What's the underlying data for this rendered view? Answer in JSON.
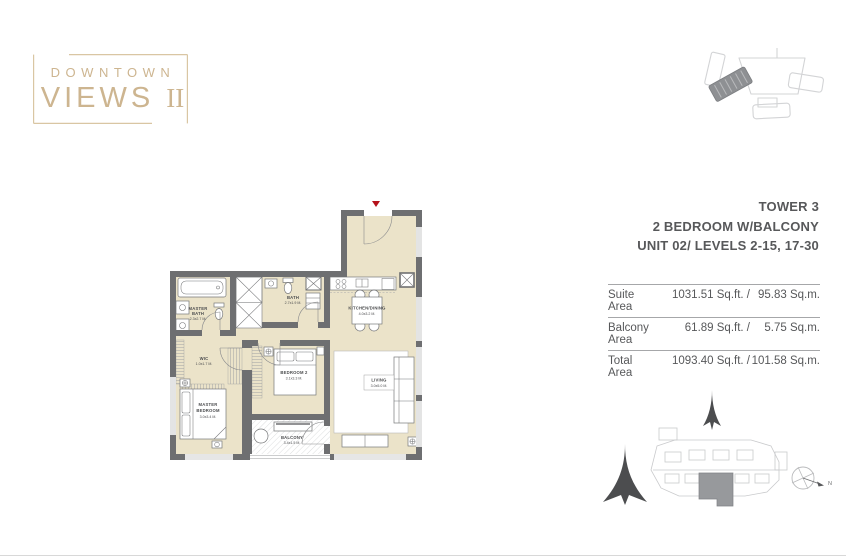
{
  "brand": {
    "line1": "DOWNTOWN",
    "line2": "VIEWS",
    "numeral": "II"
  },
  "unit_info": {
    "tower": "TOWER 3",
    "type": "2 BEDROOM W/BALCONY",
    "unit": "UNIT 02/ LEVELS 2-15, 17-30"
  },
  "area_table": {
    "rows": [
      {
        "label": "Suite Area",
        "sqft": "1031.51 Sq.ft. /",
        "sqm": "95.83 Sq.m."
      },
      {
        "label": "Balcony Area",
        "sqft": "61.89 Sq.ft. /",
        "sqm": "5.75 Sq.m."
      },
      {
        "label": "Total Area",
        "sqft": "1093.40 Sq.ft. /",
        "sqm": "101.58 Sq.m."
      }
    ]
  },
  "floor_plan": {
    "rooms": {
      "master_bath": {
        "line1": "MASTER",
        "line2": "BATH",
        "dims": "2.3x2.7 M."
      },
      "bath": {
        "name": "BATH",
        "dims": "2.7x1.9 M."
      },
      "wic": {
        "name": "WIC",
        "dims": "1.0x1.7 M."
      },
      "master_bedroom": {
        "line1": "MASTER",
        "line2": "BEDROOM",
        "dims": "3.0x3.4 M."
      },
      "bedroom2": {
        "name": "BEDROOM 2",
        "dims": "3.1x3.3 M."
      },
      "kitchen_dining": {
        "name": "KITCHEN/DINING",
        "dims": "4.0x3.2 M."
      },
      "living": {
        "name": "LIVING",
        "dims": "3.0x5.0 M."
      },
      "balcony": {
        "name": "BALCONY",
        "dims": "3.4x1.5 M."
      }
    }
  },
  "compass": {
    "label": "N"
  },
  "colors": {
    "accent_gold": "#cfb68f",
    "wall_gray": "#6e6f71",
    "floor_beige": "#ebe3c9",
    "text_gray": "#58595b",
    "marker_red": "#b5121b"
  }
}
